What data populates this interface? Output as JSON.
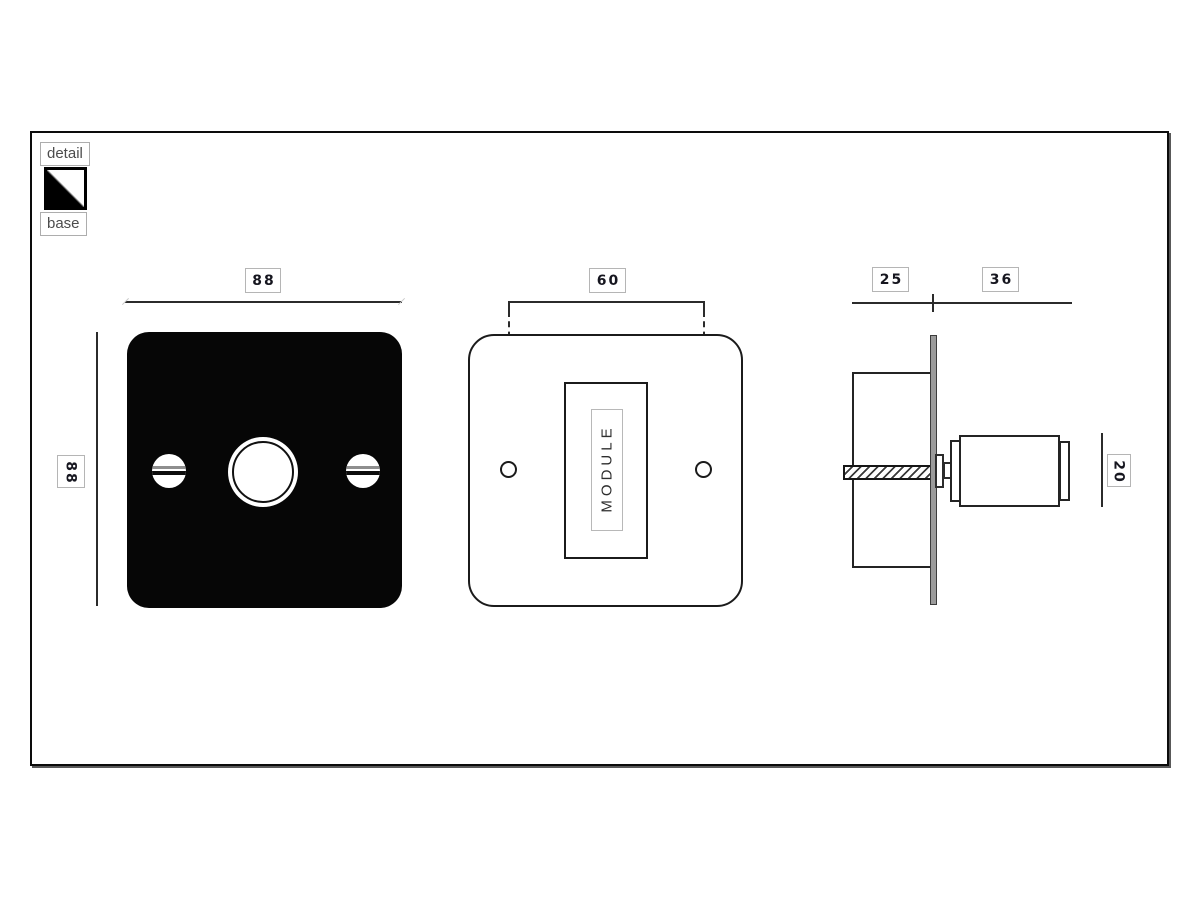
{
  "legend": {
    "detail_label": "detail",
    "base_label": "base"
  },
  "views": {
    "front": {
      "name": "front-view",
      "width_dim": "88",
      "height_dim": "88"
    },
    "module": {
      "name": "module-view",
      "hole_spacing_dim": "60",
      "module_label": "MODULE"
    },
    "side": {
      "name": "side-view",
      "back_depth_dim": "25",
      "front_depth_dim": "36",
      "knob_height_dim": "20"
    }
  },
  "colors": {
    "plate_black": "#060606",
    "line": "#2b2b2b",
    "dim_text": "#16161f",
    "label_border": "#b5b5b5",
    "faceplate_gray": "#9b9b9b",
    "background": "#ffffff"
  }
}
